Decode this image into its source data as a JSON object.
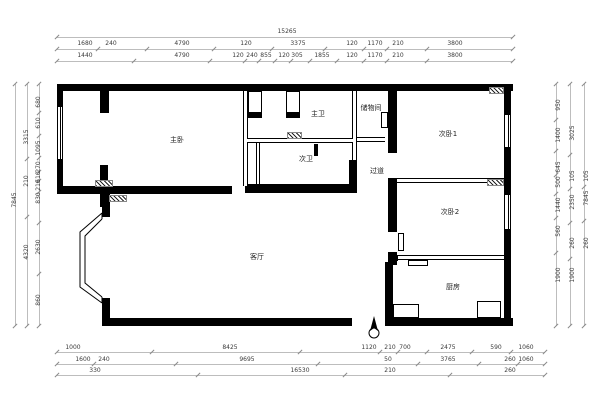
{
  "title": "apartment-floor-plan",
  "colors": {
    "wall": "#000000",
    "background": "#ffffff",
    "dim_text": "#3a3a3a",
    "dim_line": "#bdbdbd"
  },
  "rooms": [
    {
      "label": "主卧",
      "x": 177,
      "y": 140
    },
    {
      "label": "主卫",
      "x": 318,
      "y": 114
    },
    {
      "label": "次卫",
      "x": 306,
      "y": 159
    },
    {
      "label": "储物间",
      "x": 371,
      "y": 108
    },
    {
      "label": "次卧1",
      "x": 448,
      "y": 134
    },
    {
      "label": "过道",
      "x": 377,
      "y": 171
    },
    {
      "label": "次卧2",
      "x": 450,
      "y": 212
    },
    {
      "label": "客厅",
      "x": 257,
      "y": 257
    },
    {
      "label": "厨房",
      "x": 453,
      "y": 287
    }
  ],
  "dim_rows": [
    {
      "side": "top",
      "line_y": 37,
      "label_y": 32,
      "from": 57,
      "to": 513,
      "labels": [
        {
          "t": "15265",
          "p": 287
        }
      ]
    },
    {
      "side": "top",
      "line_y": 49,
      "label_y": 44,
      "from": 57,
      "to": 513,
      "labels": [
        {
          "t": "1680",
          "p": 85
        },
        {
          "t": "240",
          "p": 111
        },
        {
          "t": "4790",
          "p": 182
        },
        {
          "t": "120",
          "p": 246
        },
        {
          "t": "3375",
          "p": 298
        },
        {
          "t": "120",
          "p": 352
        },
        {
          "t": "1170",
          "p": 375
        },
        {
          "t": "210",
          "p": 398
        },
        {
          "t": "3800",
          "p": 455
        }
      ]
    },
    {
      "side": "top",
      "line_y": 61,
      "label_y": 56,
      "from": 57,
      "to": 513,
      "labels": [
        {
          "t": "1440",
          "p": 85
        },
        {
          "t": "4790",
          "p": 182
        },
        {
          "t": "120",
          "p": 238
        },
        {
          "t": "240",
          "p": 252
        },
        {
          "t": "855",
          "p": 266
        },
        {
          "t": "120",
          "p": 284
        },
        {
          "t": "305",
          "p": 297
        },
        {
          "t": "1855",
          "p": 322
        },
        {
          "t": "120",
          "p": 352
        },
        {
          "t": "1170",
          "p": 375
        },
        {
          "t": "210",
          "p": 398
        },
        {
          "t": "3800",
          "p": 455
        }
      ]
    },
    {
      "side": "bottom",
      "line_y": 352,
      "label_y": 348,
      "from": 57,
      "to": 545,
      "labels": [
        {
          "t": "1000",
          "p": 73
        },
        {
          "t": "8425",
          "p": 230
        },
        {
          "t": "1120",
          "p": 369
        },
        {
          "t": "210",
          "p": 390
        },
        {
          "t": "700",
          "p": 405
        },
        {
          "t": "2475",
          "p": 448
        },
        {
          "t": "590",
          "p": 496
        },
        {
          "t": "1060",
          "p": 526
        }
      ]
    },
    {
      "side": "bottom",
      "line_y": 364,
      "label_y": 360,
      "from": 57,
      "to": 545,
      "labels": [
        {
          "t": "1600",
          "p": 83
        },
        {
          "t": "240",
          "p": 104
        },
        {
          "t": "9695",
          "p": 247
        },
        {
          "t": "50",
          "p": 388
        },
        {
          "t": "3765",
          "p": 448
        },
        {
          "t": "260",
          "p": 510
        },
        {
          "t": "1060",
          "p": 526
        }
      ]
    },
    {
      "side": "bottom",
      "line_y": 375,
      "label_y": 371,
      "from": 57,
      "to": 545,
      "labels": [
        {
          "t": "330",
          "p": 95
        },
        {
          "t": "16530",
          "p": 300
        },
        {
          "t": "210",
          "p": 390
        },
        {
          "t": "260",
          "p": 510
        }
      ]
    },
    {
      "side": "left",
      "line_x": 15,
      "label_x": 15,
      "from": 84,
      "to": 326,
      "labels": [
        {
          "t": "7845",
          "p": 200
        }
      ]
    },
    {
      "side": "left",
      "line_x": 27,
      "label_x": 27,
      "from": 84,
      "to": 326,
      "labels": [
        {
          "t": "3315",
          "p": 137
        },
        {
          "t": "210",
          "p": 181
        },
        {
          "t": "4320",
          "p": 252
        }
      ]
    },
    {
      "side": "left",
      "line_x": 39,
      "label_x": 39,
      "from": 84,
      "to": 326,
      "labels": [
        {
          "t": "680",
          "p": 102
        },
        {
          "t": "610",
          "p": 123
        },
        {
          "t": "1095",
          "p": 148
        },
        {
          "t": "270",
          "p": 167
        },
        {
          "t": "510",
          "p": 177
        },
        {
          "t": "210",
          "p": 185
        },
        {
          "t": "830",
          "p": 198
        },
        {
          "t": "2630",
          "p": 247
        },
        {
          "t": "860",
          "p": 300
        }
      ]
    },
    {
      "side": "right",
      "line_x": 556,
      "label_x": 559,
      "from": 84,
      "to": 326,
      "labels": [
        {
          "t": "950",
          "p": 105
        },
        {
          "t": "1400",
          "p": 135
        },
        {
          "t": "645",
          "p": 167
        },
        {
          "t": "500",
          "p": 182
        },
        {
          "t": "1440",
          "p": 205
        },
        {
          "t": "560",
          "p": 231
        },
        {
          "t": "1900",
          "p": 275
        }
      ]
    },
    {
      "side": "right",
      "line_x": 570,
      "label_x": 573,
      "from": 84,
      "to": 326,
      "labels": [
        {
          "t": "3025",
          "p": 133
        },
        {
          "t": "105",
          "p": 176
        },
        {
          "t": "2350",
          "p": 202
        },
        {
          "t": "260",
          "p": 243
        },
        {
          "t": "1900",
          "p": 275
        }
      ]
    },
    {
      "side": "right",
      "line_x": 584,
      "label_x": 587,
      "from": 84,
      "to": 326,
      "labels": [
        {
          "t": "105",
          "p": 176
        },
        {
          "t": "7845",
          "p": 198
        },
        {
          "t": "260",
          "p": 243
        }
      ]
    }
  ]
}
